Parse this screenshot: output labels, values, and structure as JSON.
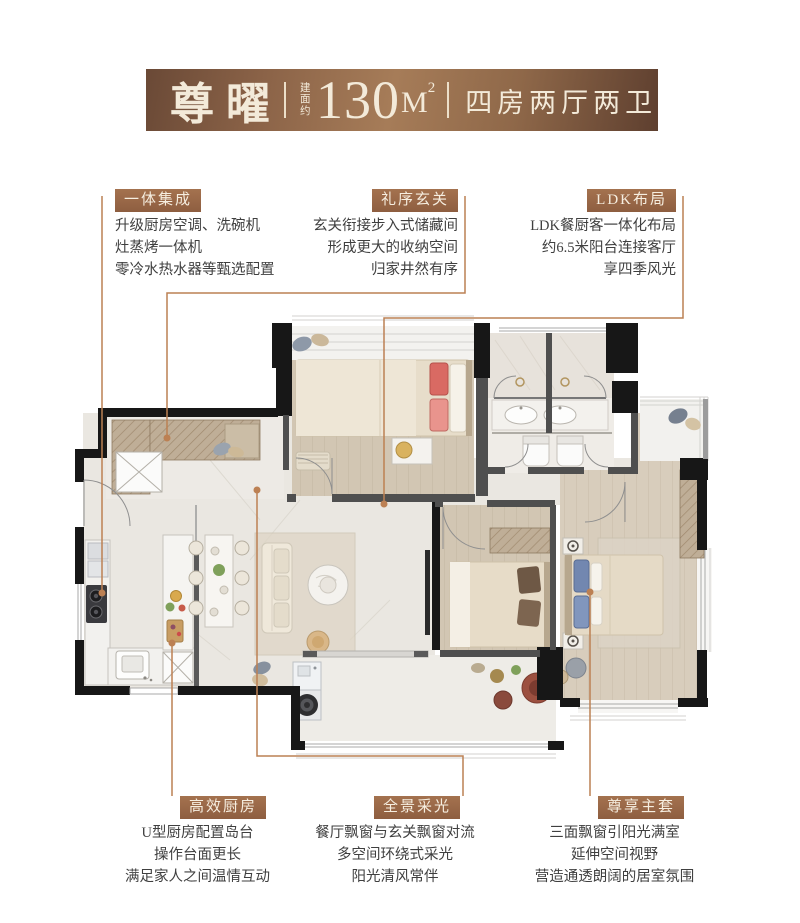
{
  "header": {
    "name": "尊曜",
    "area_prefix": "建面约",
    "area_value": "130",
    "area_unit": "M",
    "area_sup": "2",
    "layout": "四房两厅两卫"
  },
  "colors": {
    "banner_brown": "#8a6247",
    "tag_brown": "#9c6a48",
    "leader_line": "#bc8053",
    "text": "#3f3f3f"
  },
  "annotations": {
    "top_left": {
      "label": "一体集成",
      "lines": [
        "升级厨房空调、洗碗机",
        "灶蒸烤一体机",
        "零冷水热水器等甄选配置"
      ]
    },
    "top_middle": {
      "label": "礼序玄关",
      "lines": [
        "玄关衔接步入式储藏间",
        "形成更大的收纳空间",
        "归家井然有序"
      ]
    },
    "top_right": {
      "label": "LDK布局",
      "lines": [
        "LDK餐厨客一体化布局",
        "约6.5米阳台连接客厅",
        "享四季风光"
      ]
    },
    "bottom_left": {
      "label": "高效厨房",
      "lines": [
        "U型厨房配置岛台",
        "操作台面更长",
        "满足家人之间温情互动"
      ]
    },
    "bottom_middle": {
      "label": "全景采光",
      "lines": [
        "餐厅飘窗与玄关飘窗对流",
        "多空间环绕式采光",
        "阳光清风常伴"
      ]
    },
    "bottom_right": {
      "label": "尊享主套",
      "lines": [
        "三面飘窗引阳光满室",
        "延伸空间视野",
        "营造通透朗阔的居室氛围"
      ]
    }
  }
}
